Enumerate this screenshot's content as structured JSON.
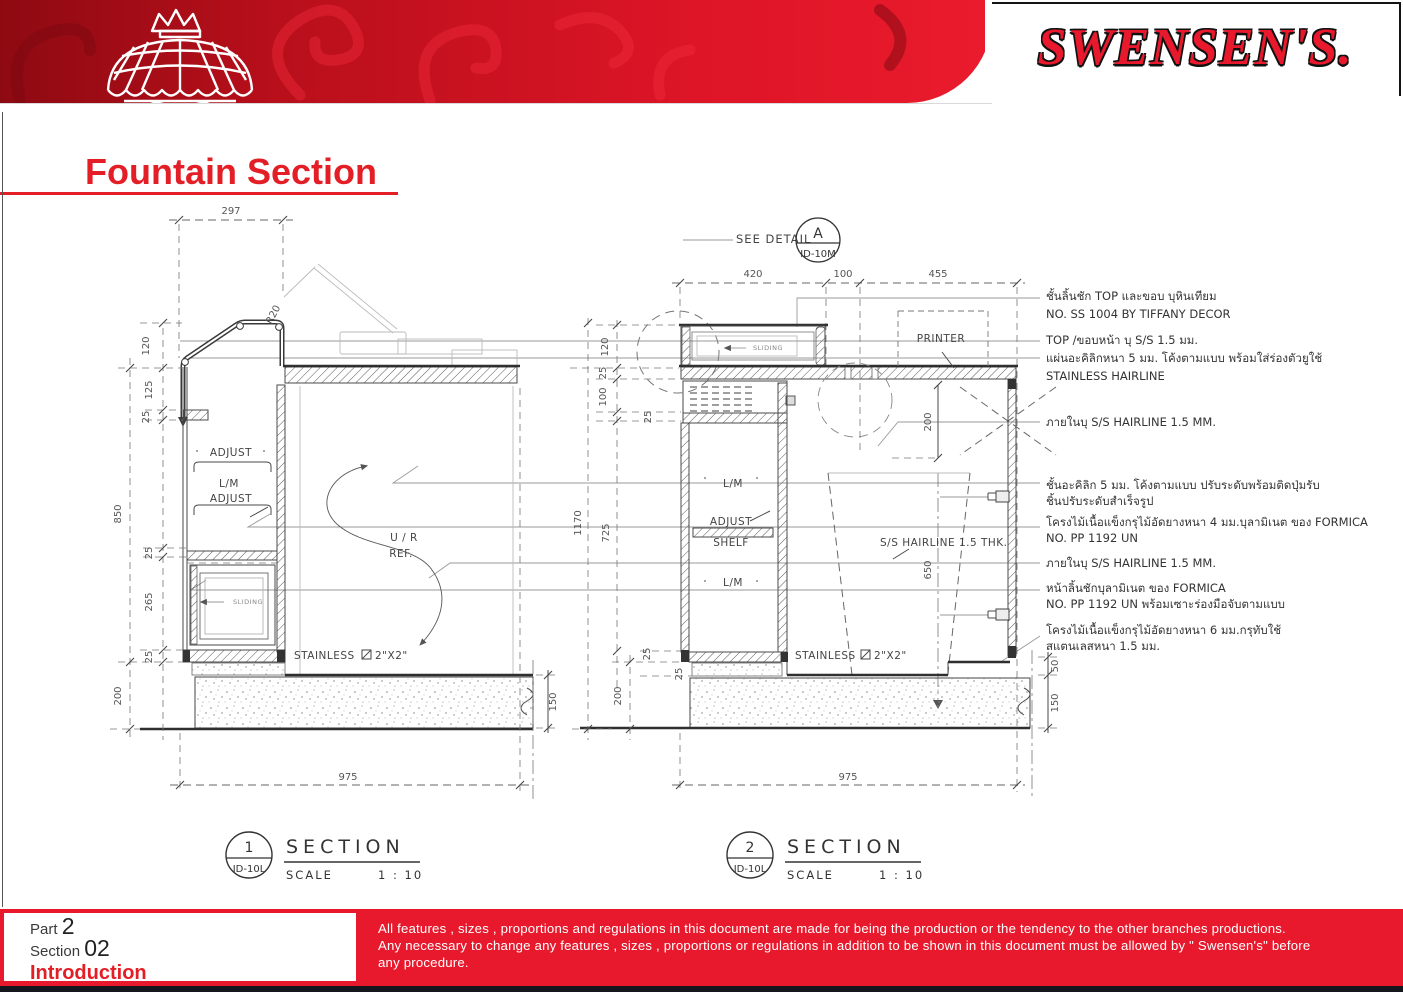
{
  "header": {
    "brand": "SWENSEN'S."
  },
  "title": "Fountain Section",
  "colors": {
    "brand_red": "#e8192c",
    "banner_dark": "#8e0a12",
    "title_red": "#e41e26",
    "bottom_bar": "#15151d"
  },
  "drawing1": {
    "dims": {
      "w297": "297",
      "r20": "R20",
      "h120": "120",
      "h125": "125",
      "h25a": "25",
      "h850": "850",
      "h25b": "25",
      "h265": "265",
      "h25c": "25",
      "h200": "200",
      "h150": "150",
      "w975": "975"
    },
    "labels": {
      "adjust_top": "ADJUST",
      "lm": "L/M",
      "adjust_bottom": "ADJUST",
      "ur_line1": "U / R",
      "ur_line2": "REF.",
      "sliding": "SLIDING",
      "stainless": "STAINLESS",
      "tube_size": "2\"X2\""
    }
  },
  "drawing2": {
    "see_detail": "SEE DETAIL",
    "detail_letter": "A",
    "detail_sheet": "ID-10M",
    "dims": {
      "w420": "420",
      "w100": "100",
      "w455": "455",
      "h120": "120",
      "h25a": "25",
      "h100": "100",
      "h25b": "25",
      "h1170": "1170",
      "h725": "725",
      "h25c": "25",
      "h25d": "25",
      "h200_left": "200",
      "h200_right": "200",
      "h650": "650",
      "h50": "50",
      "h150": "150",
      "w975": "975"
    },
    "labels": {
      "sliding": "SLIDING",
      "printer": "PRINTER",
      "lm_top": "L/M",
      "adjust": "ADJUST",
      "shelf": "SHELF",
      "lm_bottom": "L/M",
      "hairline": "S/S HAIRLINE 1.5 THK.",
      "stainless": "STAINLESS",
      "tube_size": "2\"X2\""
    }
  },
  "annotations": [
    {
      "line1": "ชั้นลิ้นชัก TOP และขอบ บุหินเทียม",
      "line2": "NO. SS 1004 BY TIFFANY DECOR"
    },
    {
      "line1": "TOP /ขอบหน้า บุ S/S 1.5 มม.",
      "line2": ""
    },
    {
      "line1": "แผ่นอะคิลิกหนา 5 มม. โค้งตามแบบ พร้อมใส่ร่องตัวยูใช้",
      "line2": "STAINLESS HAIRLINE"
    },
    {
      "line1": "ภายในบุ S/S HAIRLINE 1.5 MM.",
      "line2": ""
    },
    {
      "line1": "ชั้นอะคิลิก 5 มม. โค้งตามแบบ ปรับระดับพร้อมติดปุ่มรับ",
      "line2": "ชิ้นปรับระดับสำเร็จรูป"
    },
    {
      "line1": "โครงไม้เนื้อแข็งกรุไม้อัดยางหนา 4 มม.บุลามิเนต ของ FORMICA",
      "line2": "NO. PP 1192 UN"
    },
    {
      "line1": "ภายในบุ S/S HAIRLINE 1.5 MM.",
      "line2": ""
    },
    {
      "line1": "หน้าลิ้นชักบุลามิเนต ของ FORMICA",
      "line2": "NO. PP 1192 UN  พร้อมเซาะร่องมือจับตามแบบ"
    },
    {
      "line1": "โครงไม้เนื้อแข็งกรุไม้อัดยางหนา 6 มม.กรุทับใช้",
      "line2": "สแตนเลสหนา 1.5 มม."
    }
  ],
  "section1": {
    "number": "1",
    "sheet": "ID-10L",
    "title": "SECTION",
    "scale_label": "SCALE",
    "scale_value": "1 : 10"
  },
  "section2": {
    "number": "2",
    "sheet": "ID-10L",
    "title": "SECTION",
    "scale_label": "SCALE",
    "scale_value": "1 : 10"
  },
  "footer": {
    "part_label": "Part",
    "part_value": "2",
    "section_label": "Section",
    "section_value": "02",
    "subtitle": "Introduction",
    "disc1": "All features , sizes , proportions and regulations in this document are made for being the production or the tendency to the other branches productions.",
    "disc2": "Any necessary to change any features , sizes , proportions or regulations in addition to be shown in this document must be allowed by \" Swensen's\" before",
    "disc3": "any procedure."
  }
}
